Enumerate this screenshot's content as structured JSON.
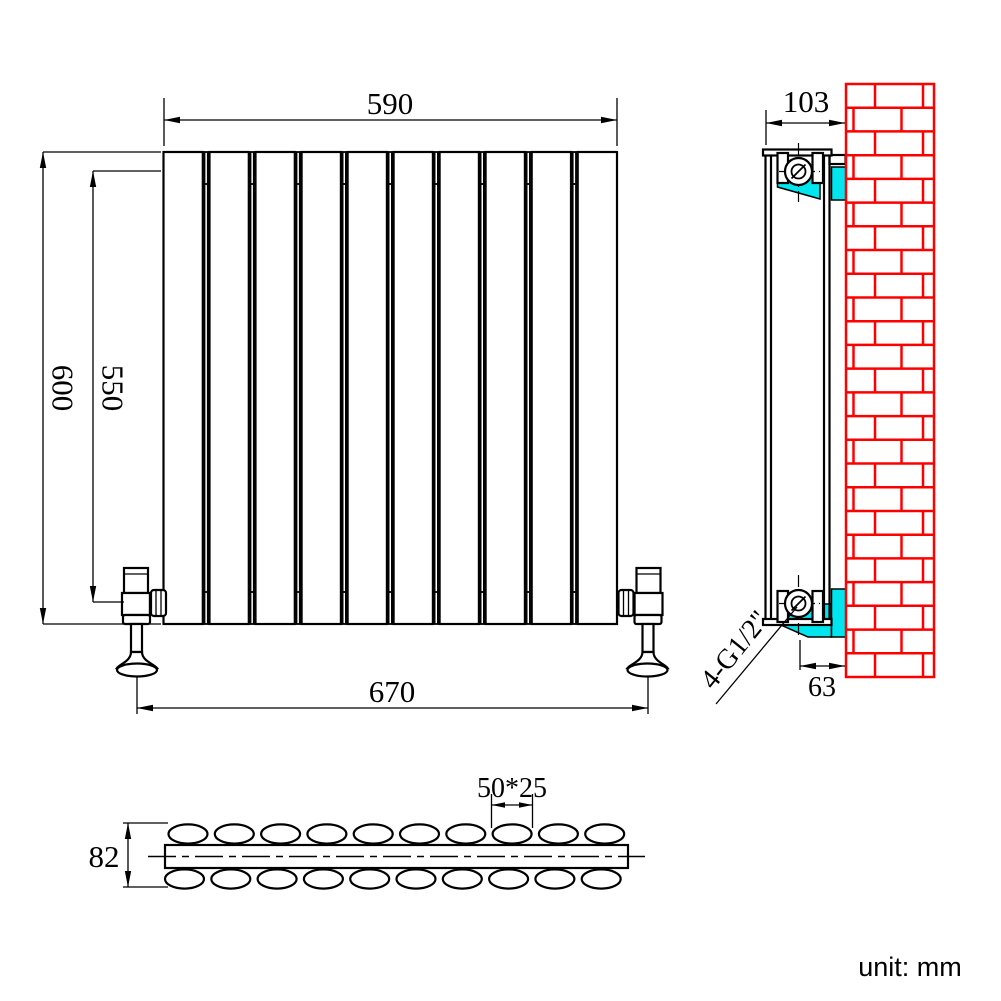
{
  "drawing": {
    "type": "radiator-installation-technical-drawing",
    "dimensions": {
      "top_width": "590",
      "overall_height": "600",
      "connection_height": "550",
      "bottom_width": "670",
      "depth": "103",
      "bracket_offset": "63",
      "section_depth": "82",
      "tube_size": "50*25",
      "connection_thread": "4-G1/2\""
    },
    "unit_note": "unit: mm",
    "counts": {
      "panels": 10,
      "gaps": 9,
      "ovals_top": 10,
      "ovals_bottom": 10,
      "brick_rows": 25
    },
    "colors": {
      "line": "#000000",
      "brick": "#fe0000",
      "bracket": "#00e5ee",
      "background": "#ffffff"
    }
  }
}
